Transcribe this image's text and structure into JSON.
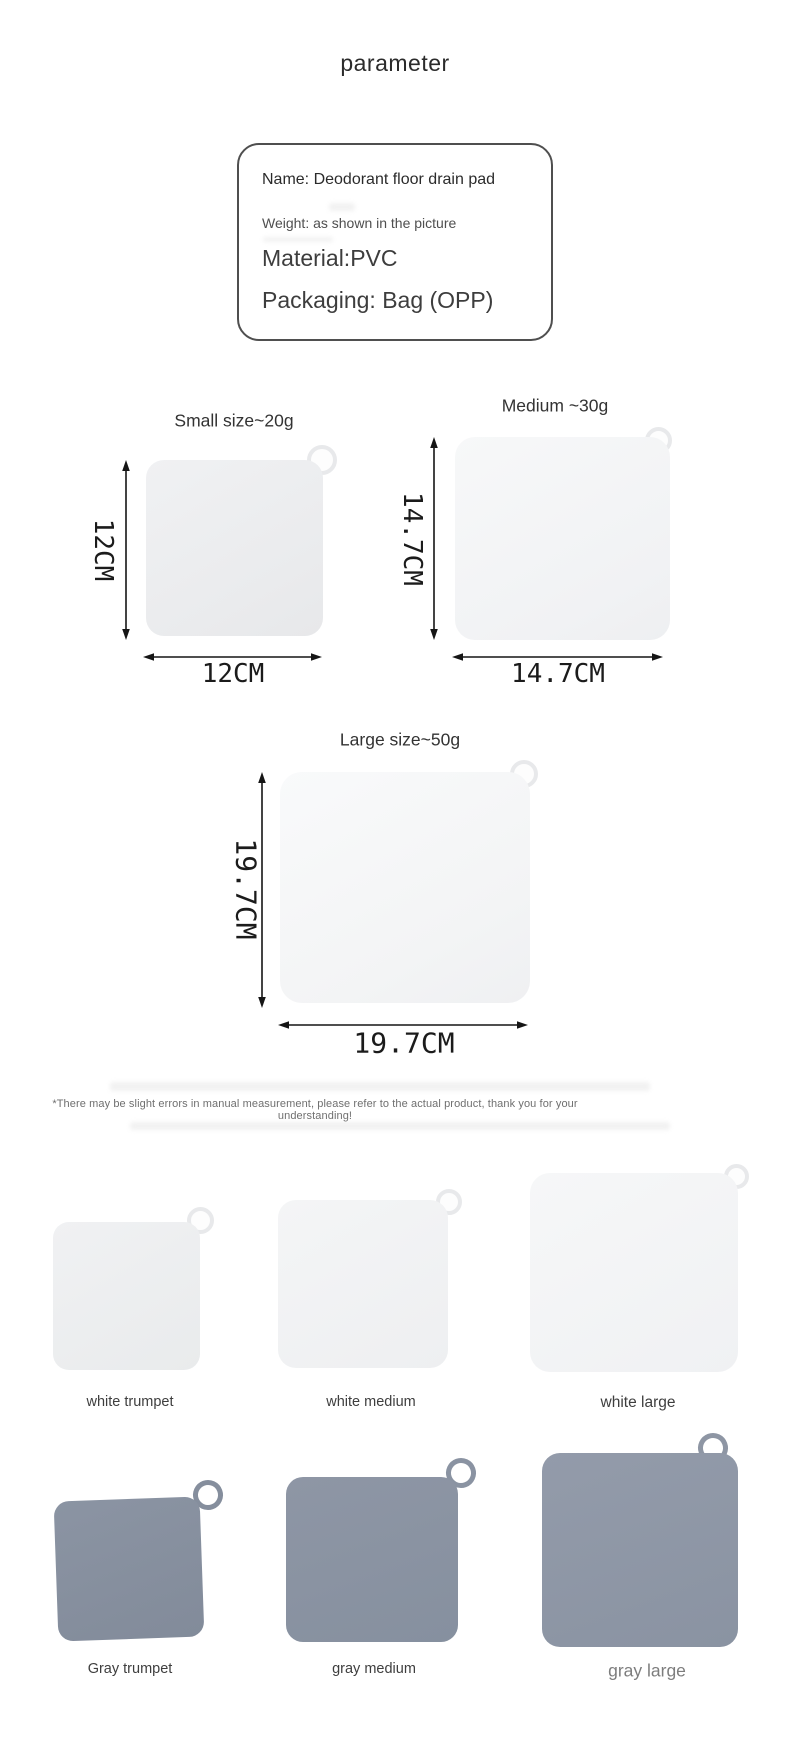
{
  "title": "parameter",
  "info_box": {
    "name": "Name: Deodorant floor drain pad",
    "weight": "Weight: as shown in the picture",
    "material": "Material:PVC",
    "packaging": "Packaging: Bag (OPP)"
  },
  "diagrams": [
    {
      "label": "Small size~20g",
      "width_dim": "12CM",
      "height_dim": "12CM"
    },
    {
      "label": "Medium ~30g",
      "width_dim": "14.7CM",
      "height_dim": "14.7CM"
    },
    {
      "label": "Large size~50g",
      "width_dim": "19.7CM",
      "height_dim": "19.7CM"
    }
  ],
  "disclaimer": "*There may be slight errors in manual measurement, please refer to the actual product, thank you for your understanding!",
  "variants": [
    {
      "label": "white trumpet"
    },
    {
      "label": "white medium"
    },
    {
      "label": "white large"
    },
    {
      "label": "Gray trumpet"
    },
    {
      "label": "gray medium"
    },
    {
      "label": "gray large"
    }
  ],
  "colors": {
    "gray_pad": "#8A93A2",
    "white_pad": "#EFF0F2",
    "arrow": "#151515",
    "box_border": "#4F4F4F"
  }
}
